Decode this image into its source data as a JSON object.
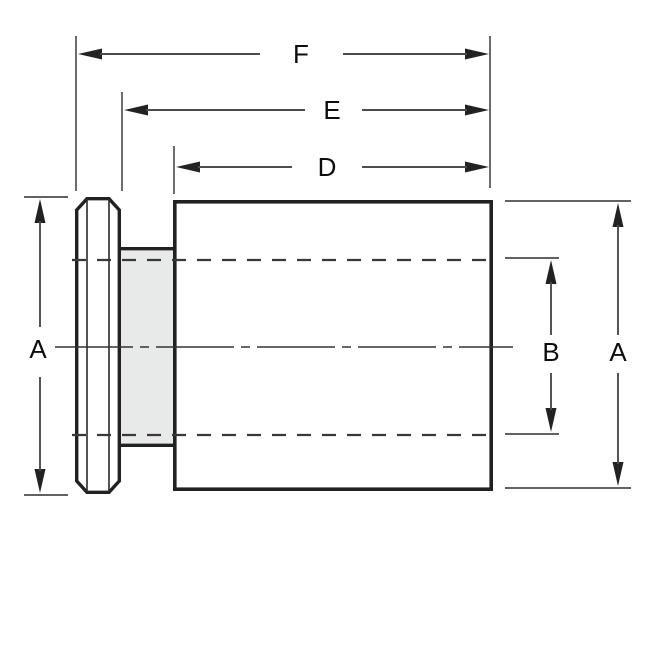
{
  "diagram": {
    "labels": {
      "f": "F",
      "e": "E",
      "d": "D",
      "a_left": "A",
      "b": "B",
      "a_right": "A"
    },
    "colors": {
      "background": "#ffffff",
      "part_fill": "#e8e9e9",
      "part_outline": "#212121",
      "dimension_line": "#4c4c4c",
      "hidden_line": "#383838",
      "center_line": "#333333",
      "arrowhead": "#222222",
      "label_text": "#0d0d0d"
    }
  }
}
